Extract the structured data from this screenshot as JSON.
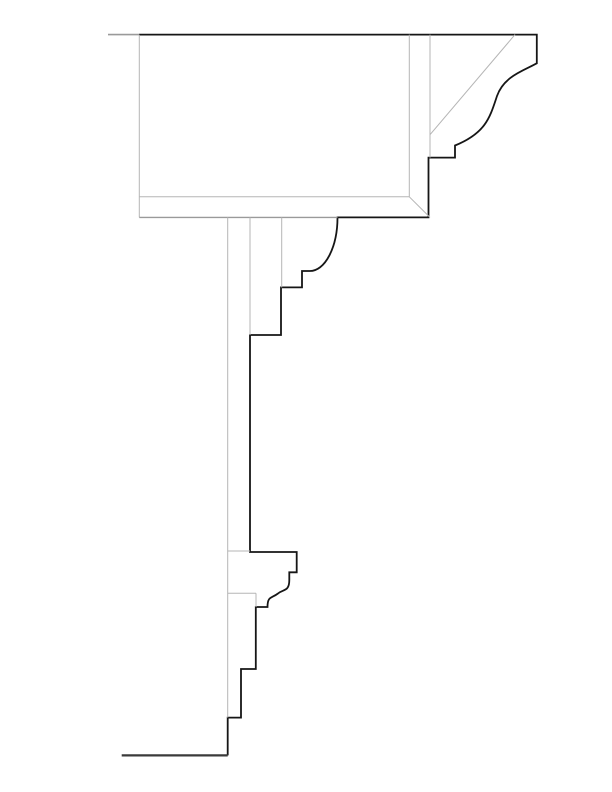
{
  "meta": {
    "title": "Architectural cornice and molding section detail",
    "canvas": {
      "width": 612,
      "height": 792,
      "background": "#ffffff"
    }
  },
  "colors": {
    "profile": "#161616",
    "construction": "#b5b5b5",
    "construction_dark": "#9a9a9a",
    "floor": "#3a3a3a"
  },
  "drawing": {
    "paths": [
      {
        "name": "cornice-profile-outline",
        "stroke": "profile",
        "width": 1.8,
        "d": "M 139 34.6 L 536.8 34.6 L 536.8 63.3 C 524 70.5 504 76 497 96 C 490 117 486 133 455 145.5 L 455 157.6 L 428.5 157.6 L 428.5 217.4 L 337.5 217.4 A 27.5 53.6 0 0 1 310 271 L 302 271 L 302 287.4 L 281 287.4 L 281 335 L 250 335 L 250 552 L 296.7 552 L 296.7 572.3 L 289.3 572.3 L 289.3 580 C 289.3 592 283 589 278 593.5 C 271.5 598.5 267.5 596 267.5 607 L 255.8 607 L 255.8 669 L 241 669 L 241 717.6 L 227.7 717.6 L 227.7 755.4"
      },
      {
        "name": "floor-ground-line",
        "stroke": "floor",
        "width": 2.2,
        "d": "M 227.7 755.4 L 121.7 755.4"
      },
      {
        "name": "roof-line-extension",
        "stroke": "construction_dark",
        "width": 1.6,
        "d": "M 108 34.6 L 139 34.6"
      },
      {
        "name": "beam-left-edge-line",
        "stroke": "construction",
        "width": 1,
        "d": "M 139.3 34.6 L 139.3 217.4"
      },
      {
        "name": "beam-bottom-hidden-edge",
        "stroke": "construction_dark",
        "width": 1.4,
        "d": "M 139.3 217.4 L 337.5 217.4"
      },
      {
        "name": "beam-inner-bottom-line",
        "stroke": "construction",
        "width": 1,
        "d": "M 139.3 196.8 L 409.3 196.8"
      },
      {
        "name": "beam-inner-right-line",
        "stroke": "construction",
        "width": 1,
        "d": "M 409.3 34.6 L 409.3 196.8"
      },
      {
        "name": "beam-corner-miter-line",
        "stroke": "construction",
        "width": 1,
        "d": "M 409.3 196.8 L 430 217.4"
      },
      {
        "name": "fascia-inner-edge-line",
        "stroke": "construction",
        "width": 1,
        "d": "M 430 34.6 L 430 157.6"
      },
      {
        "name": "cornice-soffit-diagonal",
        "stroke": "construction",
        "width": 1,
        "d": "M 515 34.6 L 430 134.7"
      },
      {
        "name": "wall-face-line",
        "stroke": "construction",
        "width": 1,
        "d": "M 227.7 217.4 L 227.7 717.6"
      },
      {
        "name": "frieze-face-line",
        "stroke": "construction",
        "width": 1,
        "d": "M 250 217.4 L 250 335"
      },
      {
        "name": "bed-mould-face-line",
        "stroke": "construction",
        "width": 1,
        "d": "M 281.7 217.4 L 281.7 287.4"
      },
      {
        "name": "band-top-hidden-line",
        "stroke": "construction",
        "width": 1,
        "d": "M 227.7 551 L 250 551"
      },
      {
        "name": "band-bottom-hidden-line",
        "stroke": "construction",
        "width": 1,
        "d": "M 227.7 593.3 L 256 593.3"
      },
      {
        "name": "band-hidden-edge-line",
        "stroke": "construction",
        "width": 1,
        "d": "M 256 593.3 L 256 607"
      }
    ]
  }
}
